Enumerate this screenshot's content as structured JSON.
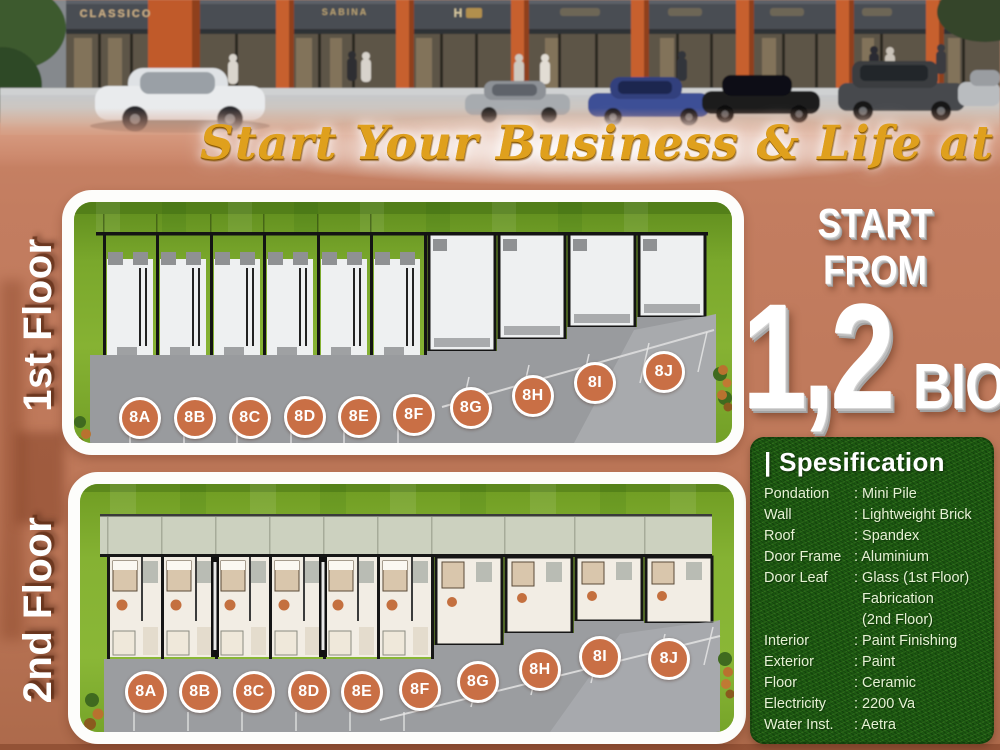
{
  "hero": {
    "signs": [
      "CLASSICO",
      "SABINA",
      "H"
    ]
  },
  "tagline": "Start Your Business & Life at Ease",
  "floor1": {
    "label": "1st Floor",
    "units": [
      "8A",
      "8B",
      "8C",
      "8D",
      "8E",
      "8F",
      "8G",
      "8H",
      "8I",
      "8J"
    ]
  },
  "floor2": {
    "label": "2nd Floor",
    "units": [
      "8A",
      "8B",
      "8C",
      "8D",
      "8E",
      "8F",
      "8G",
      "8H",
      "8I",
      "8J"
    ]
  },
  "price": {
    "start_from": "START FROM",
    "amount": "1,2",
    "unit": "BIO"
  },
  "specification": {
    "title": "| Spesification",
    "rows": [
      {
        "label": "Pondation",
        "value": ": Mini Pile"
      },
      {
        "label": "Wall",
        "value": ": Lightweight Brick"
      },
      {
        "label": "Roof",
        "value": ": Spandex"
      },
      {
        "label": "Door Frame",
        "value": ": Aluminium"
      },
      {
        "label": "Door Leaf",
        "value": ": Glass (1st Floor)",
        "extra": [
          "Fabrication",
          "(2nd Floor)"
        ]
      },
      {
        "label": "Interior",
        "value": ": Paint Finishing"
      },
      {
        "label": "Exterior",
        "value": ": Paint"
      },
      {
        "label": "Floor",
        "value": ": Ceramic"
      },
      {
        "label": "Electricity",
        "value": ": 2200 Va"
      },
      {
        "label": "Water Inst.",
        "value": ": Aetra"
      }
    ]
  },
  "colors": {
    "background_salmon": "#c37d60",
    "badge_orange": "#c96f45",
    "spec_green": "#1d5a12",
    "grass_green": "#7aa82c",
    "gold_text": "#dfa01d",
    "pillar_orange": "#c05a2c"
  }
}
